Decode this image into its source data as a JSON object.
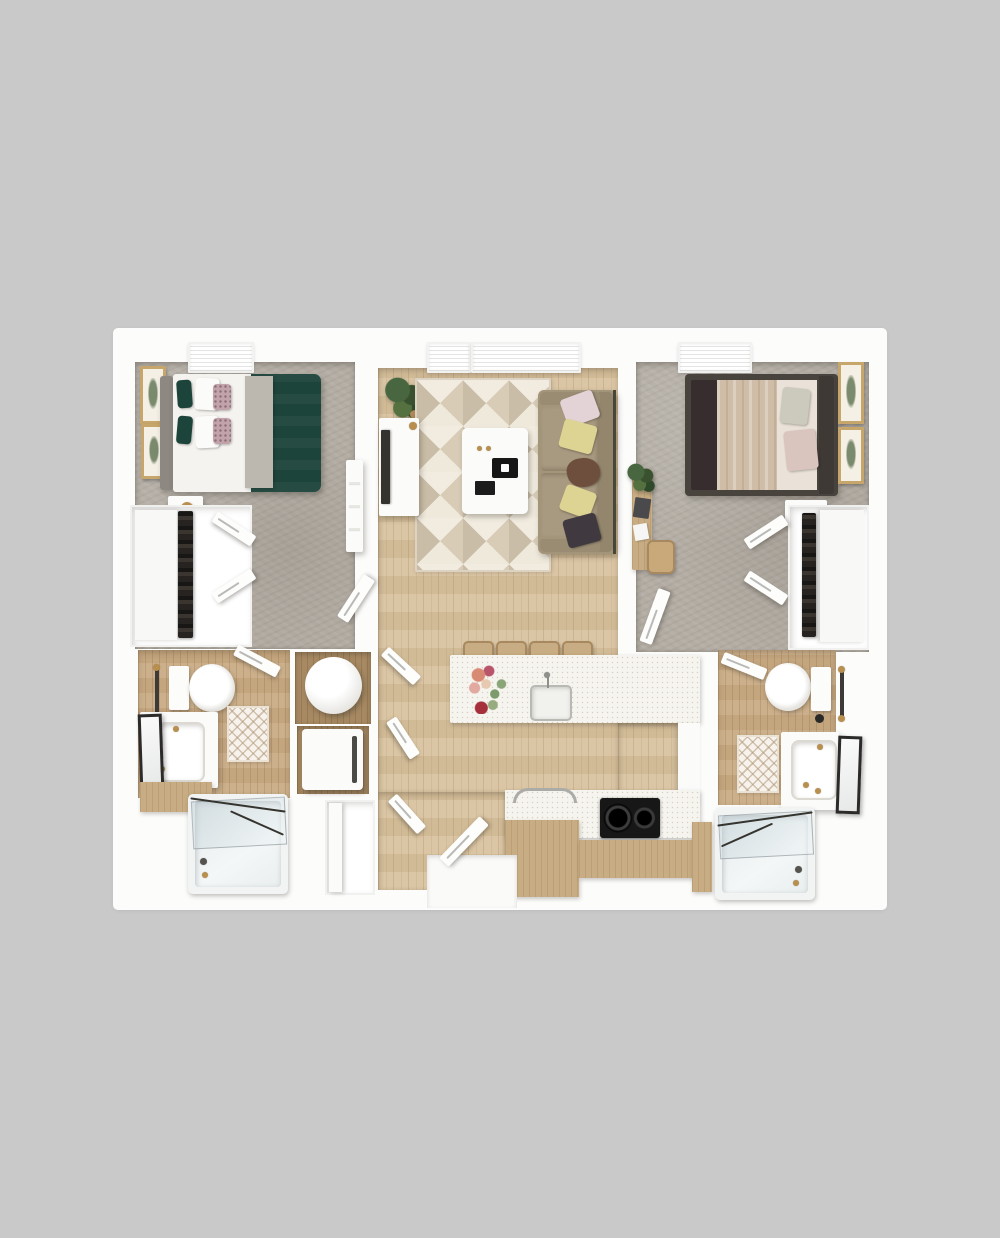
{
  "image_type": "3d-rendered-apartment-floor-plan-top-view",
  "palette": {
    "bg": "#c9c9c9",
    "plan": "#fcfcfb",
    "carpet": "#b3ada4",
    "wood": "#d7c19d",
    "wood_bath": "#c9ab84",
    "wood_niche": "#a78a63",
    "counter": "#f6f4ee",
    "tan_cabinet": "#c8ac83",
    "duvet_green": "#1d443a",
    "sofa": "#a3957a",
    "rug_a": "#d8ccb7",
    "rug_b": "#efe9dc",
    "rug_c": "#c9bda7",
    "rug_d": "#f2ece0",
    "bed2_frame": "#49433e",
    "bed2_blanket": "#cfbda7",
    "blush": "#d9c4be",
    "yellow_pillow": "#ddd392",
    "brown_pillow": "#6e4e3c",
    "dark_pillow": "#403a40",
    "black": "#171717",
    "gold": "#b98f4e",
    "frame_gold": "#c6a66b",
    "metal": "#8f8f8c",
    "white_furn": "#fbfbfa",
    "plant": "#48663f",
    "gray_throw": "#bcb8b0",
    "headboard_gray": "#8d8881",
    "art_fill": "#7a8a6d"
  },
  "scene": {
    "rooms": [
      {
        "id": "bedroom-1",
        "position": "top-left",
        "flooring": "carpet",
        "furniture": [
          "bed-green-duvet",
          "green-pillows",
          "patterned-pillows",
          "gray-throw",
          "nightstand",
          "table-lamp",
          "wall-art-x2",
          "dresser",
          "walk-in-closet",
          "bifold-doors",
          "window",
          "door"
        ]
      },
      {
        "id": "living-room",
        "position": "top-center",
        "flooring": "hardwood",
        "furniture": [
          "sofa",
          "throw-pillows-x5",
          "geometric-area-rug",
          "coffee-table",
          "decor-tray",
          "books",
          "candles",
          "tv-console",
          "tv",
          "potted-plant",
          "windows-x2"
        ]
      },
      {
        "id": "bedroom-2",
        "position": "top-right",
        "flooring": "carpet",
        "furniture": [
          "upholstered-bed",
          "draped-blanket",
          "pillows",
          "nightstand",
          "table-lamp",
          "desk",
          "desk-chair",
          "laptop",
          "potted-plant",
          "wall-art-x2",
          "walk-in-closet",
          "bifold-doors",
          "window",
          "door"
        ]
      },
      {
        "id": "bathroom-1",
        "position": "bottom-left",
        "flooring": "hardwood",
        "furniture": [
          "toilet",
          "towel-bar",
          "vanity-sink",
          "leaning-mirror",
          "diamond-bath-mat",
          "bathtub-with-glass-screen",
          "door"
        ]
      },
      {
        "id": "laundry-utility-closet",
        "position": "center-left",
        "furniture": [
          "water-heater",
          "washer-dryer",
          "linen-closet"
        ]
      },
      {
        "id": "kitchen",
        "position": "center",
        "furniture": [
          "island-with-sink",
          "faucet",
          "flower-bouquet",
          "bar-stools-x4",
          "range",
          "black-cooktop",
          "tan-cabinets",
          "pantry-cabinet"
        ]
      },
      {
        "id": "entry",
        "position": "bottom-center",
        "furniture": [
          "entry-door",
          "landing"
        ]
      },
      {
        "id": "bathroom-2",
        "position": "bottom-right",
        "flooring": "hardwood",
        "furniture": [
          "toilet",
          "towel-bar",
          "vanity-sink",
          "leaning-mirror",
          "diamond-bath-mat",
          "bathtub-with-glass-screen",
          "door"
        ]
      }
    ]
  }
}
